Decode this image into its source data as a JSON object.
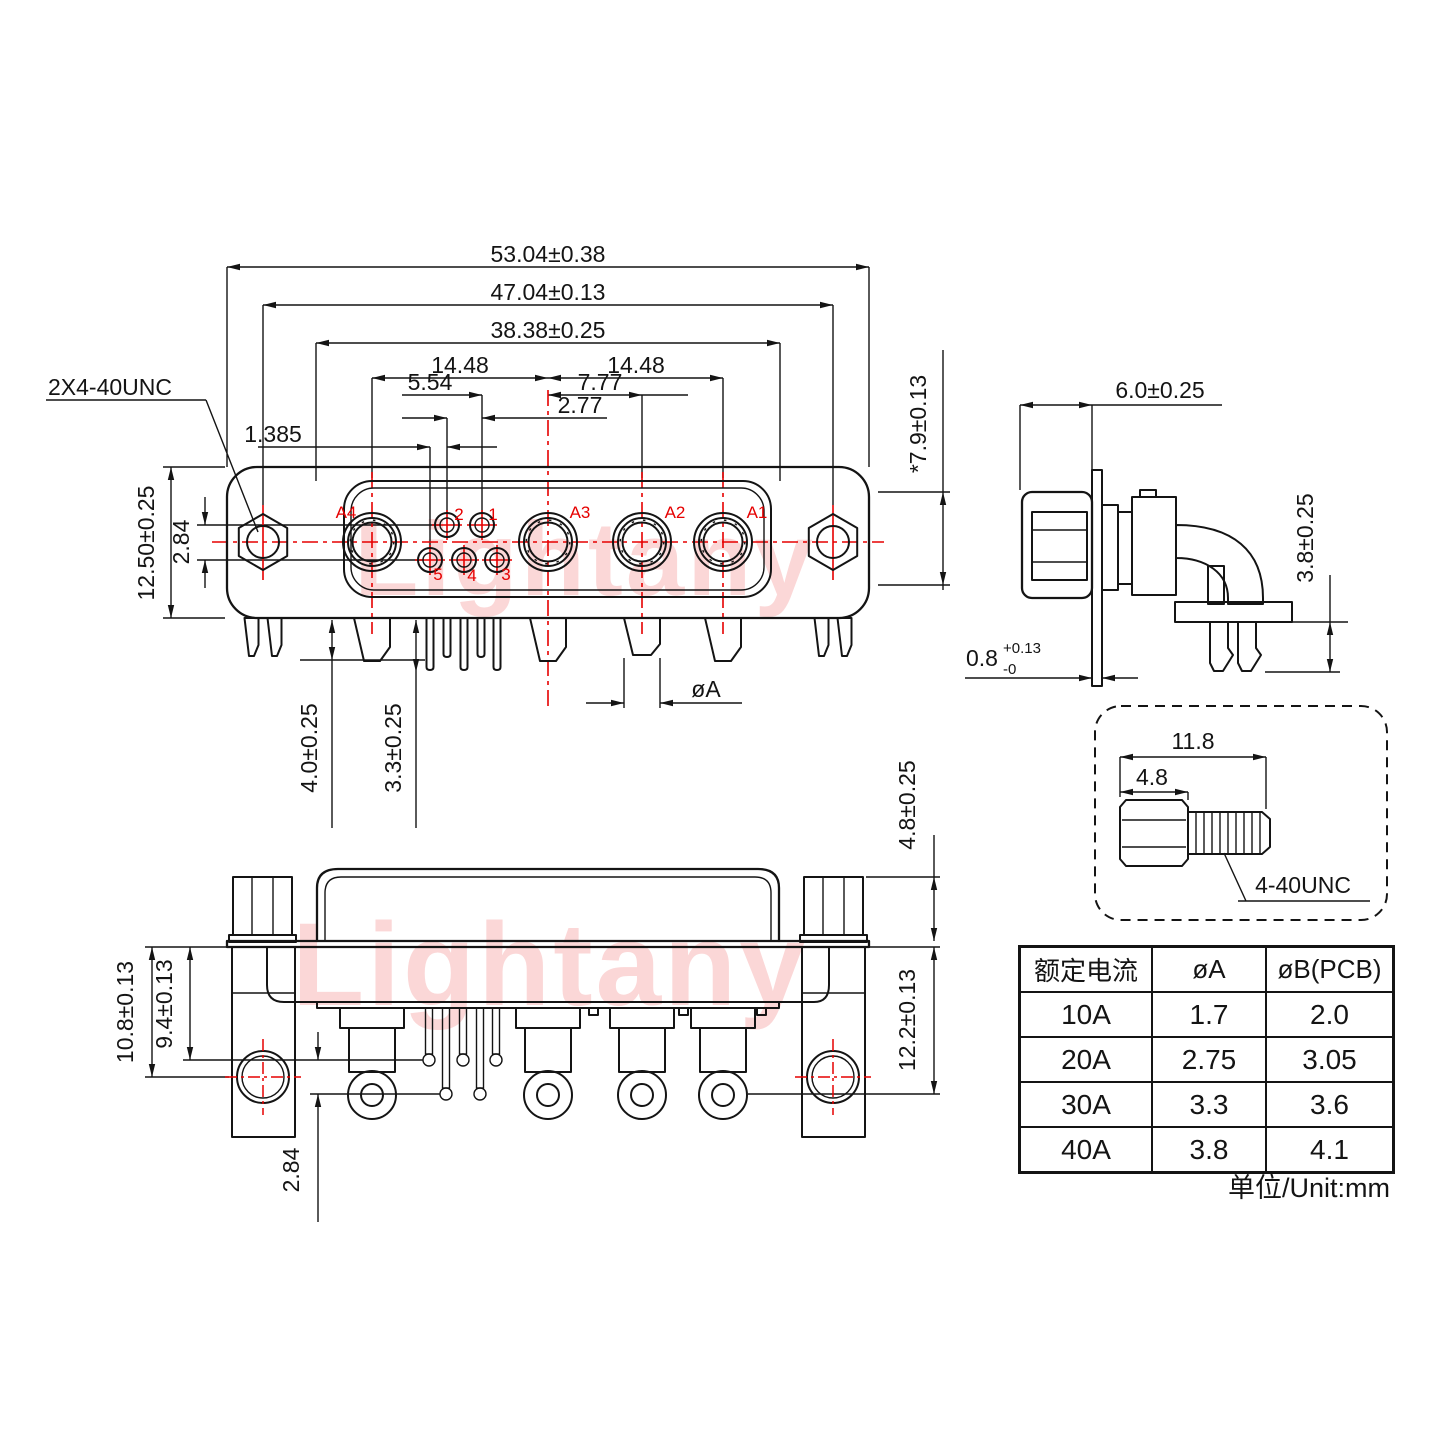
{
  "watermark": {
    "text": "Lightany",
    "color": "#fbd7d7"
  },
  "colors": {
    "line": "#141414",
    "accent_red": "#e60000"
  },
  "front_view": {
    "thread_callout": "2X4-40UNC",
    "dims": {
      "overall_width": "53.04±0.38",
      "screw_span": "47.04±0.13",
      "shell_width": "38.38±0.25",
      "pitch_left": "14.48",
      "pitch_right": "14.48",
      "small_pin_span": "5.54",
      "a2_offset": "7.77",
      "small_pitch": "2.77",
      "half_pitch": "1.385",
      "overall_height": "12.50±0.25",
      "row_offset": "2.84",
      "standoff_length": "4.0±0.25",
      "signal_pin_length": "3.3±0.25",
      "power_pin_dia": "øA"
    },
    "contacts": {
      "a1": "A1",
      "a2": "A2",
      "a3": "A3",
      "a4": "A4",
      "p1": "1",
      "p2": "2",
      "p3": "3",
      "p4": "4",
      "p5": "5"
    }
  },
  "side_view": {
    "dims": {
      "half_height": "*7.9±0.13",
      "bracket_depth": "6.0±0.25",
      "clip_length": "3.8±0.25",
      "flange_thickness": "0.8",
      "flange_tol_plus": "+0.13",
      "flange_tol_minus": "-0"
    }
  },
  "screw_detail": {
    "dims": {
      "overall_length": "11.8",
      "head_length": "4.8"
    },
    "thread_spec": "4-40UNC"
  },
  "bottom_view": {
    "dims": {
      "standoff_height": "4.8±0.25",
      "hole_offset": "10.8±0.13",
      "pin_row_upper": "9.4±0.13",
      "pin_row_lower": "12.2±0.13",
      "row_offset": "2.84"
    }
  },
  "spec_table": {
    "headers": [
      "额定电流",
      "øA",
      "øB(PCB)"
    ],
    "rows": [
      [
        "10A",
        "1.7",
        "2.0"
      ],
      [
        "20A",
        "2.75",
        "3.05"
      ],
      [
        "30A",
        "3.3",
        "3.6"
      ],
      [
        "40A",
        "3.8",
        "4.1"
      ]
    ],
    "unit_note": "单位/Unit:mm"
  }
}
